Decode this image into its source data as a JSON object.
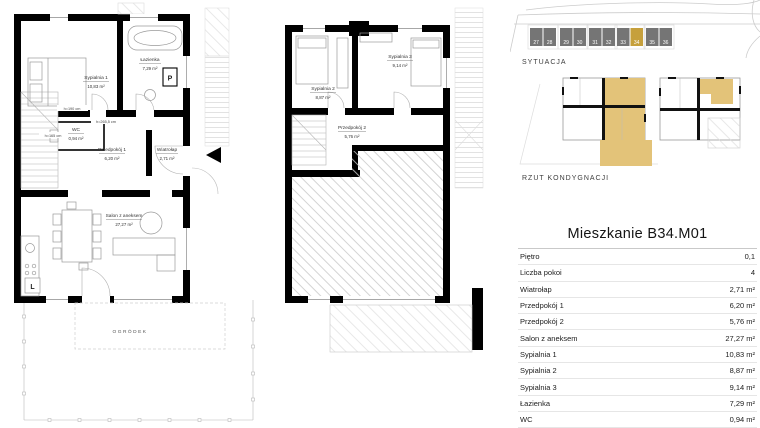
{
  "site_plan": {
    "label": "SYTUACJA",
    "units": [
      "27",
      "28",
      "29",
      "30",
      "31",
      "32",
      "33",
      "34",
      "35",
      "36"
    ],
    "highlighted_unit": "34",
    "unit_color": "#757575",
    "highlight_color": "#C6A03C"
  },
  "floor_diagram": {
    "label": "RZUT KONDYGNACJI",
    "highlight_color": "#E3C379"
  },
  "ground_floor": {
    "rooms": {
      "sypialnia1": {
        "name": "Sypialnia 1",
        "area": "10,83 m²"
      },
      "lazienka": {
        "name": "Łazienka",
        "area": "7,29 m²"
      },
      "wc": {
        "name": "WC",
        "area": "0,94 m²"
      },
      "przedpokoj1": {
        "name": "Przedpokój 1",
        "area": "6,20 m²"
      },
      "wiatrolap": {
        "name": "Wiatrołap",
        "area": "2,71 m²"
      },
      "salon": {
        "name": "Salon z aneksem",
        "area": "27,27 m²"
      }
    },
    "annotations": {
      "a1": "h=190 cm",
      "a2": "h=265,5 cm",
      "a3": "h=165 cm"
    },
    "garden_label": "OGRÓDEK",
    "washing_machine_label": "P",
    "fridge_label": "L"
  },
  "upper_floor": {
    "rooms": {
      "sypialnia2": {
        "name": "Sypialnia 2",
        "area": "8,87 m²"
      },
      "sypialnia3": {
        "name": "Sypialnia 3",
        "area": "9,14 m²"
      },
      "przedpokoj2": {
        "name": "Przedpokój 2",
        "area": "5,76 m²"
      }
    }
  },
  "details_table": {
    "title": "Mieszkanie B34.M01",
    "rows": [
      {
        "label": "Piętro",
        "value": "0,1"
      },
      {
        "label": "Liczba pokoi",
        "value": "4"
      },
      {
        "label": "Wiatrołap",
        "value": "2,71 m²"
      },
      {
        "label": "Przedpokój 1",
        "value": "6,20 m²"
      },
      {
        "label": "Przedpokój 2",
        "value": "5,76 m²"
      },
      {
        "label": "Salon z aneksem",
        "value": "27,27 m²"
      },
      {
        "label": "Sypialnia 1",
        "value": "10,83 m²"
      },
      {
        "label": "Sypialnia 2",
        "value": "8,87 m²"
      },
      {
        "label": "Sypialnia 3",
        "value": "9,14 m²"
      },
      {
        "label": "Łazienka",
        "value": "7,29 m²"
      },
      {
        "label": "WC",
        "value": "0,94 m²"
      },
      {
        "label": "Ogródek",
        "value": ""
      }
    ]
  }
}
